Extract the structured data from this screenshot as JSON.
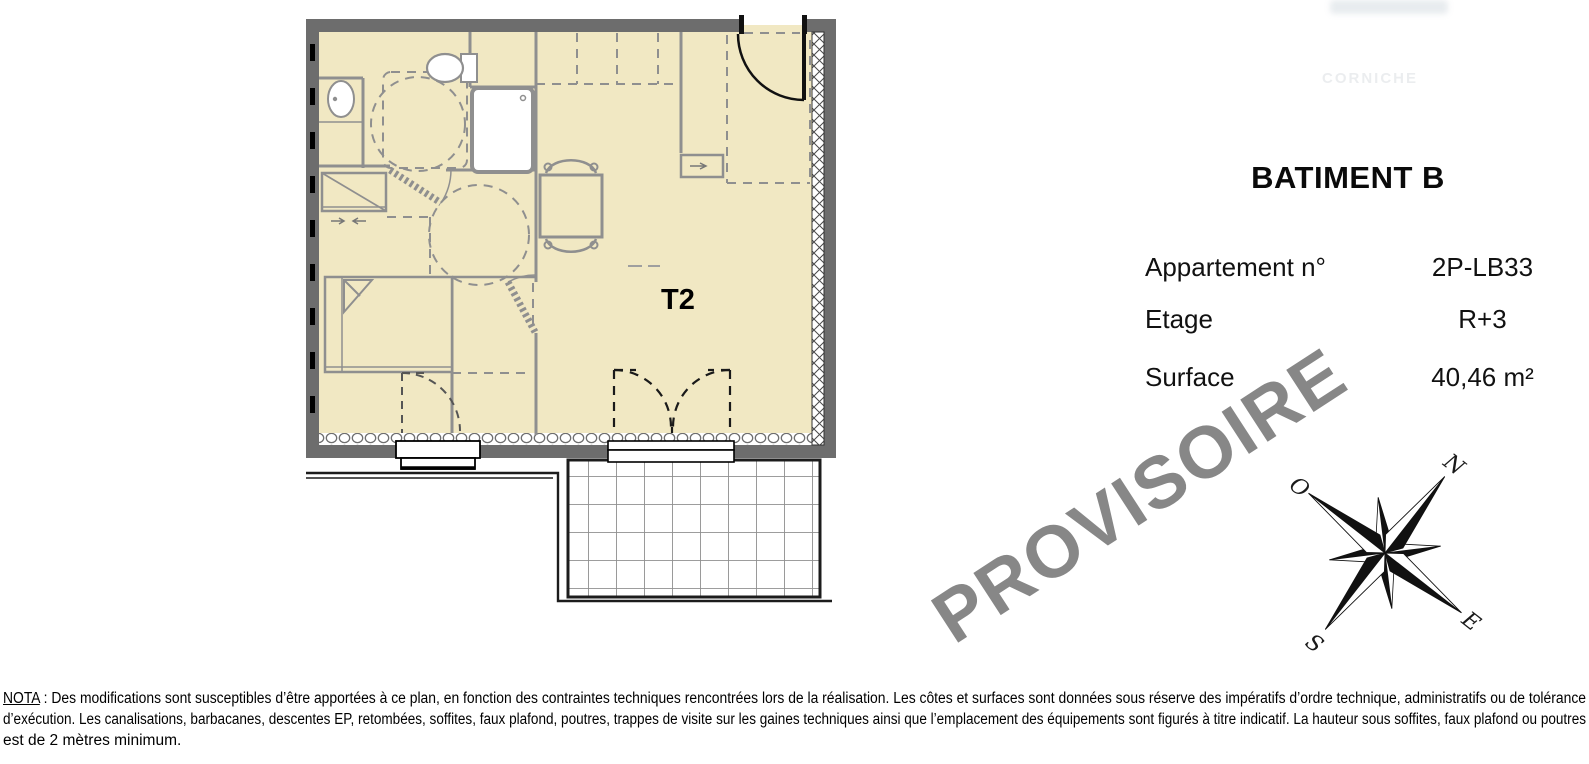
{
  "info_panel": {
    "title": "BATIMENT B",
    "rows": [
      {
        "label": "Appartement n°",
        "value": "2P-LB33"
      },
      {
        "label": "Etage",
        "value": "R+3"
      },
      {
        "label": "Surface",
        "value": "40,46 m²"
      }
    ]
  },
  "plan": {
    "unit_label": "T2"
  },
  "watermark": "PROVISOIRE",
  "ghost_text": "CORNICHE",
  "compass": {
    "north": "N",
    "east": "E",
    "south": "S",
    "west": "O"
  },
  "nota": {
    "label": "NOTA",
    "line1": " : Des modifications sont susceptibles d’être apportées à ce plan, en fonction des contraintes techniques rencontrées lors de la réalisation. Les côtes et surfaces sont données sous réserve des impératifs d’ordre technique, administratifs ou de tolérance",
    "line2": "d’exécution. Les canalisations, barbacanes, descentes EP, retombées, soffites, faux plafond, poutres, trappes de visite sur les gaines techniques ainsi que l’emplacement des équipements sont figurés à titre indicatif. La hauteur sous soffites, faux plafond ou poutres",
    "line3": "est de 2 mètres minimum."
  },
  "colors": {
    "floor_fill": "#f1e8c3",
    "wall": "#6d6d6d",
    "partition": "#8f8f8f",
    "watermark": "#878787"
  }
}
